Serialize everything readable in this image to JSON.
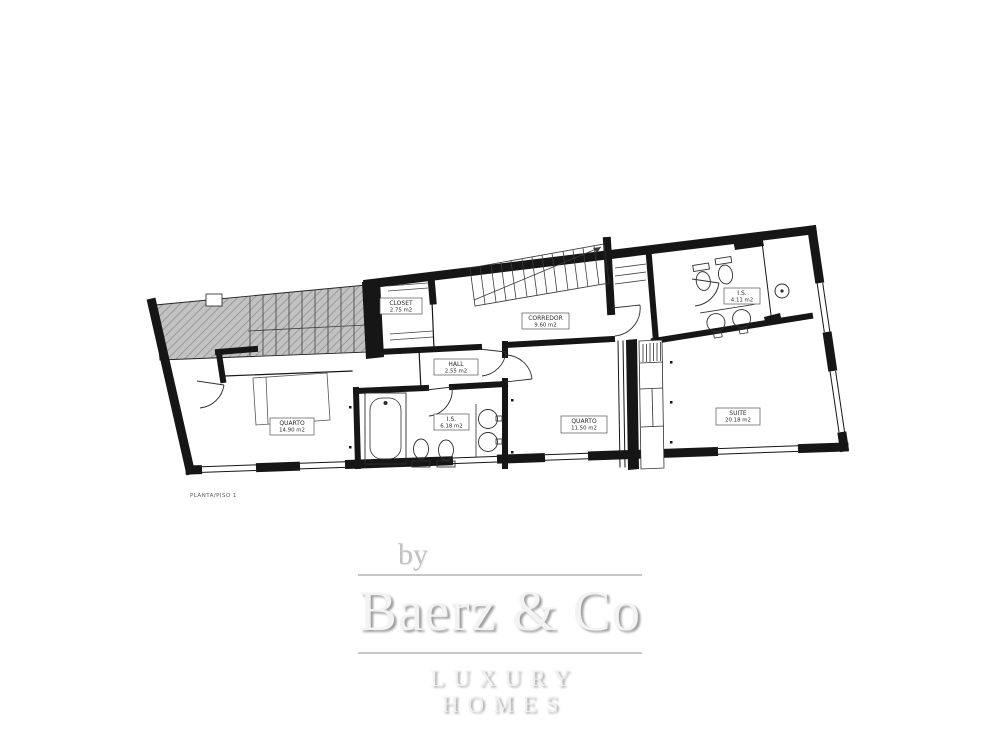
{
  "plan": {
    "caption": "PLANTA/PISO 1",
    "labels": {
      "closet": {
        "name": "CLOSET",
        "area": "2.75 m2"
      },
      "corredor": {
        "name": "CORREDOR",
        "area": "9.60 m2"
      },
      "hall": {
        "name": "HALL",
        "area": "2.55 m2"
      },
      "quarto1": {
        "name": "QUARTO",
        "area": "14.90 m2"
      },
      "is1": {
        "name": "I.S.",
        "area": "6.18 m2"
      },
      "quarto2": {
        "name": "QUARTO",
        "area": "11.50 m2"
      },
      "suite": {
        "name": "SUITE",
        "area": "20.18 m2"
      },
      "is2": {
        "name": "I.S.",
        "area": "4.11 m2"
      }
    },
    "colors": {
      "wall": "#161616",
      "hatch_fill": "#c2c2c2"
    }
  },
  "watermark": {
    "prefix": "by",
    "brand": "Baerz & Co",
    "tagline": "LUXURY HOMES",
    "color": "#c7c7c7"
  }
}
